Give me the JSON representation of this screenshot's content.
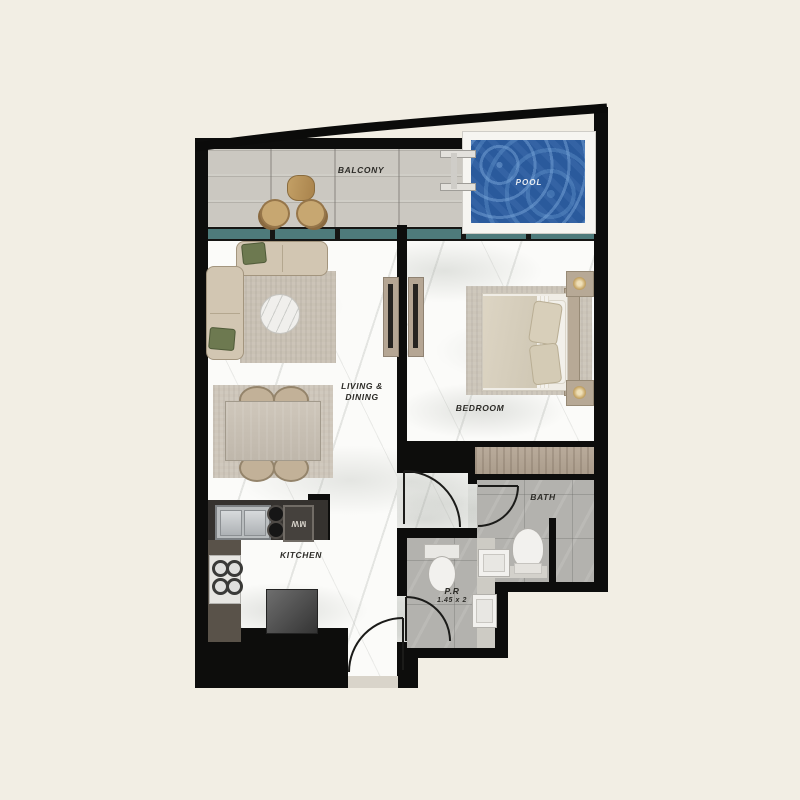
{
  "plan_title": "apartment-floor-plan",
  "rooms": {
    "balcony": {
      "label": "BALCONY"
    },
    "pool": {
      "label": "POOL"
    },
    "living_dining": {
      "label_line1": "LIVING &",
      "label_line2": "DINING"
    },
    "bedroom": {
      "label": "BEDROOM"
    },
    "bath": {
      "label": "BATH"
    },
    "powder_room": {
      "label": "P.R",
      "dimensions": "1.45 x 2"
    },
    "kitchen": {
      "label": "KITCHEN"
    }
  },
  "appliances": {
    "microwave": "MW"
  },
  "palette": {
    "background_cream": "#f2eee4",
    "wall_black": "#0d0d0c",
    "window_glass_teal": "#4e7b7b",
    "pool_water_blue": "#2a5a9c",
    "marble_floor": "#fbfbf9",
    "tile_gray": "#b3b2ae",
    "balcony_wood": "#cbc8c1",
    "wardrobe_wood": "#b3a494",
    "sofa_beige": "#d2c6b2",
    "pillow_green": "#6d7950"
  }
}
